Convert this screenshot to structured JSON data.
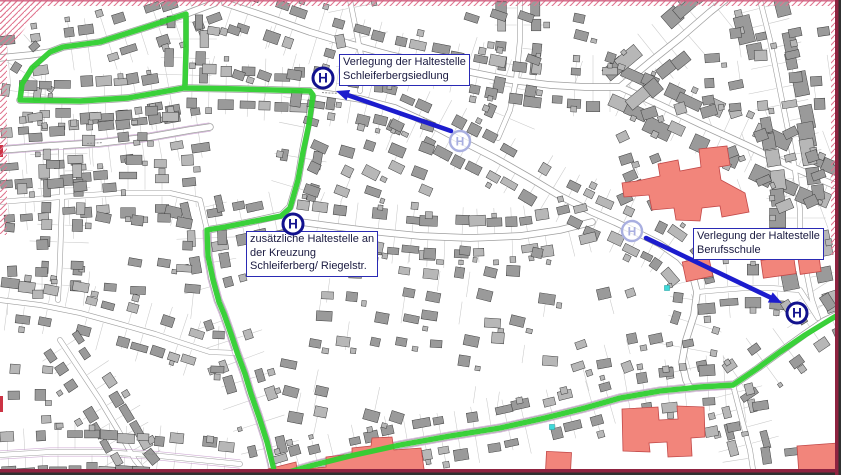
{
  "map": {
    "h_symbol": "H",
    "colors": {
      "route_green": "#2fcf2f",
      "annotation_blue": "#1c1ccd",
      "h_navy": "#12128e",
      "faded_stop": "#a9afe0",
      "building_gray": "#9a9a9a",
      "building_light": "#b7b7b7",
      "building_stroke": "#3f3f3f",
      "road_casing": "#9f9f9f",
      "lot_line": "#c9c9c9",
      "violet_line": "#c9a0cf",
      "landmark_red": "#f2857b",
      "landmark_stroke": "#c24848",
      "hatch_pink": "#e0758f",
      "frame_maroon": "#8e2340",
      "frame_dark": "#303030",
      "cyan_marker": "#3fd9d9",
      "edge_tick_red": "#cc3344"
    },
    "labels": [
      {
        "x": 339,
        "y": 54,
        "lines": [
          "Verlegung der Haltestelle",
          "Schleiferbergsiedlung",
          ""
        ]
      },
      {
        "x": 246,
        "y": 231,
        "lines": [
          "zusätzliche Haltestelle an",
          "der Kreuzung",
          "Schleiferberg/ Riegelstr."
        ]
      },
      {
        "x": 693,
        "y": 228,
        "lines": [
          "Verlegung der Haltestelle",
          "Berufsschule",
          ""
        ]
      }
    ],
    "stops_new": [
      {
        "x": 323,
        "y": 78
      },
      {
        "x": 293,
        "y": 224
      },
      {
        "x": 797,
        "y": 313
      }
    ],
    "stops_old": [
      {
        "x": 460,
        "y": 141
      },
      {
        "x": 632,
        "y": 231
      }
    ],
    "arrows": [
      {
        "from": [
          451,
          131
        ],
        "to": [
          336,
          91
        ]
      },
      {
        "from": [
          646,
          238
        ],
        "to": [
          782,
          303
        ]
      }
    ],
    "route": [
      [
        184,
        88
      ],
      [
        128,
        98
      ],
      [
        80,
        101
      ],
      [
        20,
        100
      ],
      [
        22,
        84
      ],
      [
        32,
        68
      ],
      [
        50,
        52
      ],
      [
        63,
        47
      ],
      [
        100,
        42
      ],
      [
        150,
        26
      ],
      [
        186,
        14
      ],
      [
        186,
        50
      ],
      [
        185,
        85
      ],
      [
        184,
        88
      ],
      [
        240,
        89
      ],
      [
        310,
        91
      ],
      [
        313,
        95
      ],
      [
        309,
        124
      ],
      [
        303,
        152
      ],
      [
        298,
        180
      ],
      [
        290,
        208
      ],
      [
        281,
        216
      ],
      [
        250,
        222
      ],
      [
        225,
        227
      ],
      [
        207,
        230
      ],
      [
        208,
        256
      ],
      [
        213,
        280
      ],
      [
        219,
        302
      ],
      [
        224,
        314
      ],
      [
        231,
        334
      ],
      [
        238,
        355
      ],
      [
        245,
        374
      ],
      [
        251,
        394
      ],
      [
        259,
        417
      ],
      [
        267,
        442
      ],
      [
        273,
        466
      ],
      [
        275,
        476
      ],
      [
        310,
        466
      ],
      [
        350,
        456
      ],
      [
        400,
        445
      ],
      [
        450,
        436
      ],
      [
        500,
        428
      ],
      [
        545,
        418
      ],
      [
        585,
        408
      ],
      [
        620,
        398
      ],
      [
        660,
        391
      ],
      [
        700,
        387
      ],
      [
        733,
        385
      ],
      [
        758,
        368
      ],
      [
        780,
        352
      ],
      [
        805,
        335
      ],
      [
        836,
        316
      ]
    ],
    "roads": [
      {
        "p": [
          [
            0,
            58
          ],
          [
            30,
            55
          ],
          [
            50,
            52
          ],
          [
            63,
            47
          ],
          [
            100,
            42
          ],
          [
            150,
            26
          ],
          [
            186,
            14
          ],
          [
            215,
            3
          ]
        ],
        "w": "m"
      },
      {
        "p": [
          [
            186,
            14
          ],
          [
            186,
            50
          ],
          [
            185,
            85
          ]
        ],
        "w": "s"
      },
      {
        "p": [
          [
            50,
            52
          ],
          [
            32,
            68
          ],
          [
            22,
            84
          ],
          [
            20,
            100
          ]
        ],
        "w": "s"
      },
      {
        "p": [
          [
            20,
            100
          ],
          [
            80,
            101
          ],
          [
            128,
            98
          ],
          [
            184,
            88
          ],
          [
            240,
            89
          ],
          [
            310,
            91
          ],
          [
            360,
            99
          ],
          [
            395,
            108
          ],
          [
            430,
            124
          ],
          [
            460,
            140
          ],
          [
            495,
            158
          ],
          [
            530,
            178
          ],
          [
            560,
            196
          ],
          [
            592,
            212
          ],
          [
            615,
            222
          ],
          [
            632,
            230
          ],
          [
            660,
            244
          ],
          [
            680,
            258
          ],
          [
            692,
            272
          ],
          [
            697,
            292
          ],
          [
            694,
            315
          ],
          [
            686,
            340
          ],
          [
            682,
            362
          ],
          [
            686,
            380
          ],
          [
            690,
            388
          ]
        ],
        "w": "m"
      },
      {
        "p": [
          [
            313,
            93
          ],
          [
            309,
            120
          ],
          [
            303,
            150
          ],
          [
            298,
            180
          ],
          [
            290,
            207
          ],
          [
            282,
            215
          ]
        ],
        "w": "m"
      },
      {
        "p": [
          [
            282,
            215
          ],
          [
            250,
            222
          ],
          [
            225,
            227
          ],
          [
            207,
            230
          ]
        ],
        "w": "m"
      },
      {
        "p": [
          [
            207,
            230
          ],
          [
            208,
            255
          ],
          [
            212,
            278
          ],
          [
            218,
            300
          ],
          [
            223,
            312
          ],
          [
            230,
            332
          ],
          [
            237,
            353
          ],
          [
            244,
            372
          ],
          [
            250,
            392
          ],
          [
            258,
            415
          ],
          [
            266,
            440
          ],
          [
            272,
            465
          ],
          [
            274,
            476
          ]
        ],
        "w": "m",
        "v": true
      },
      {
        "p": [
          [
            276,
            476
          ],
          [
            310,
            466
          ],
          [
            350,
            456
          ],
          [
            400,
            445
          ],
          [
            450,
            436
          ],
          [
            500,
            428
          ],
          [
            545,
            418
          ],
          [
            585,
            408
          ],
          [
            620,
            398
          ],
          [
            660,
            391
          ],
          [
            700,
            387
          ],
          [
            733,
            385
          ]
        ],
        "w": "m",
        "v": true
      },
      {
        "p": [
          [
            733,
            385
          ],
          [
            758,
            368
          ],
          [
            780,
            352
          ],
          [
            805,
            334
          ],
          [
            824,
            321
          ],
          [
            841,
            313
          ]
        ],
        "w": "m"
      },
      {
        "p": [
          [
            282,
            215
          ],
          [
            293,
            221
          ],
          [
            330,
            226
          ],
          [
            370,
            231
          ],
          [
            420,
            236
          ],
          [
            470,
            238
          ],
          [
            520,
            236
          ],
          [
            560,
            230
          ],
          [
            592,
            222
          ]
        ],
        "w": "m"
      },
      {
        "p": [
          [
            620,
            87
          ],
          [
            660,
            105
          ],
          [
            700,
            124
          ],
          [
            748,
            146
          ],
          [
            790,
            166
          ],
          [
            841,
            188
          ]
        ],
        "w": "m",
        "big": true
      },
      {
        "p": [
          [
            620,
            87
          ],
          [
            650,
            62
          ],
          [
            680,
            38
          ],
          [
            710,
            12
          ],
          [
            725,
            0
          ]
        ],
        "w": "m",
        "big": true
      },
      {
        "p": [
          [
            760,
            0
          ],
          [
            770,
            40
          ],
          [
            778,
            80
          ],
          [
            788,
            130
          ],
          [
            795,
            170
          ],
          [
            800,
            210
          ],
          [
            800,
            240
          ],
          [
            806,
            270
          ],
          [
            812,
            300
          ],
          [
            818,
            318
          ]
        ],
        "w": "s",
        "big": true
      },
      {
        "p": [
          [
            350,
            0
          ],
          [
            356,
            30
          ],
          [
            362,
            60
          ],
          [
            360,
            91
          ]
        ],
        "w": "s"
      },
      {
        "p": [
          [
            520,
            0
          ],
          [
            520,
            40
          ],
          [
            516,
            80
          ],
          [
            510,
            110
          ],
          [
            498,
            138
          ]
        ],
        "w": "s"
      },
      {
        "p": [
          [
            0,
            150
          ],
          [
            50,
            146
          ],
          [
            100,
            143
          ],
          [
            150,
            137
          ],
          [
            190,
            130
          ],
          [
            210,
            127
          ]
        ],
        "w": "m",
        "v": true
      },
      {
        "p": [
          [
            0,
            202
          ],
          [
            60,
            197
          ],
          [
            120,
            193
          ],
          [
            170,
            193
          ],
          [
            200,
            200
          ],
          [
            207,
            230
          ]
        ],
        "w": "s"
      },
      {
        "p": [
          [
            0,
            300
          ],
          [
            40,
            305
          ],
          [
            80,
            313
          ],
          [
            120,
            324
          ],
          [
            155,
            334
          ],
          [
            185,
            344
          ],
          [
            210,
            352
          ],
          [
            237,
            353
          ]
        ],
        "w": "s"
      },
      {
        "p": [
          [
            60,
            340
          ],
          [
            80,
            370
          ],
          [
            100,
            400
          ],
          [
            118,
            430
          ],
          [
            135,
            460
          ],
          [
            148,
            476
          ]
        ],
        "w": "s"
      },
      {
        "p": [
          [
            0,
            455
          ],
          [
            50,
            452
          ],
          [
            100,
            452
          ],
          [
            150,
            455
          ],
          [
            200,
            460
          ],
          [
            240,
            464
          ]
        ],
        "w": "s",
        "v": true
      },
      {
        "p": [
          [
            61,
            146
          ],
          [
            62,
            200
          ],
          [
            60,
            260
          ],
          [
            58,
            300
          ]
        ],
        "w": "s"
      },
      {
        "p": [
          [
            697,
            292
          ],
          [
            720,
            290
          ],
          [
            745,
            288
          ],
          [
            770,
            288
          ],
          [
            800,
            290
          ],
          [
            818,
            318
          ]
        ],
        "w": "s"
      },
      {
        "p": [
          [
            225,
            3
          ],
          [
            270,
            18
          ],
          [
            310,
            32
          ],
          [
            350,
            44
          ],
          [
            390,
            55
          ],
          [
            430,
            64
          ],
          [
            470,
            72
          ],
          [
            510,
            80
          ],
          [
            550,
            85
          ],
          [
            585,
            87
          ],
          [
            620,
            87
          ]
        ],
        "w": "m"
      },
      {
        "p": [
          [
            733,
            385
          ],
          [
            742,
            420
          ],
          [
            750,
            450
          ],
          [
            754,
            476
          ]
        ],
        "w": "s"
      }
    ],
    "zones": [
      {
        "x": 28,
        "y": 104,
        "w": 150,
        "h": 42,
        "r": -5,
        "d": 0.7
      },
      {
        "x": 15,
        "y": 152,
        "w": 190,
        "h": 46,
        "r": -4,
        "d": 0.7
      },
      {
        "x": 70,
        "y": 210,
        "w": 130,
        "h": 88,
        "r": 6,
        "d": 0.5
      },
      {
        "x": 305,
        "y": 115,
        "w": 140,
        "h": 90,
        "r": 22,
        "d": 0.7
      },
      {
        "x": 315,
        "y": 240,
        "w": 245,
        "h": 92,
        "r": 8,
        "d": 0.65
      },
      {
        "x": 565,
        "y": 285,
        "w": 120,
        "h": 95,
        "r": -15,
        "d": 0.55
      },
      {
        "x": 615,
        "y": 100,
        "w": 222,
        "h": 115,
        "r": -20,
        "d": 0.5
      },
      {
        "x": 282,
        "y": 335,
        "w": 140,
        "h": 85,
        "r": 12,
        "d": 0.6
      },
      {
        "x": 430,
        "y": 330,
        "w": 130,
        "h": 72,
        "r": 8,
        "d": 0.55
      },
      {
        "x": 700,
        "y": 25,
        "w": 138,
        "h": 95,
        "r": -8,
        "d": 0.7
      },
      {
        "x": 465,
        "y": 5,
        "w": 150,
        "h": 75,
        "r": 18,
        "d": 0.55
      },
      {
        "x": 5,
        "y": 340,
        "w": 55,
        "h": 85,
        "r": 2,
        "d": 0.55
      },
      {
        "x": 700,
        "y": 395,
        "w": 105,
        "h": 72,
        "r": -8,
        "d": 0.4
      },
      {
        "x": 200,
        "y": 20,
        "w": 108,
        "h": 58,
        "r": 15,
        "d": 0.55
      },
      {
        "x": 0,
        "y": 215,
        "w": 68,
        "h": 80,
        "r": 0,
        "d": 0.45
      }
    ],
    "landmarks": {
      "paths": [
        "M637,181 L660,176 L658,164 L678,160 L680,171 L701,167 L699,149 L727,146 L730,165 L719,167 L721,180 L745,193 L749,212 L722,217 L720,206 L702,208 L700,221 L676,220 L674,208 L652,210 L649,195 L624,197 L622,183 Z",
        "M268,469 L296,462 L297,470 L326,467 L326,457 L352,454 L352,448 L371,446 L372,438 L392,437 L394,450 L421,448 L425,476 L268,476 Z",
        "M622,409 L658,407 L659,420 L678,419 L677,406 L704,407 L705,437 L691,438 L692,456 L668,457 L667,442 L649,443 L650,452 L623,451 Z",
        "M797,446 L838,443 L841,444 L841,475 L799,475 Z"
      ],
      "rects": [
        {
          "x": 684,
          "y": 259,
          "w": 27,
          "h": 20,
          "r": -12
        },
        {
          "x": 762,
          "y": 258,
          "w": 33,
          "h": 18,
          "r": -8
        },
        {
          "x": 799,
          "y": 256,
          "w": 21,
          "h": 17,
          "r": -8
        },
        {
          "x": 546,
          "y": 452,
          "w": 25,
          "h": 20,
          "r": 3
        }
      ]
    },
    "hatch": {
      "rects": [
        [
          0,
          0,
          841,
          6
        ],
        [
          0,
          0,
          7,
          235
        ],
        [
          831,
          0,
          10,
          255
        ]
      ],
      "poly": "M0,0 L48,0 L14,42 L0,48 Z"
    },
    "cyan_markers": [
      [
        552,
        427
      ],
      [
        667,
        288
      ]
    ],
    "edge_ticks": [
      [
        0,
        396,
        3,
        16
      ],
      [
        0,
        145,
        3,
        12
      ]
    ],
    "street_marks": [
      {
        "x": 430,
        "y": 121,
        "a": 28
      },
      {
        "x": 222,
        "y": 310,
        "a": 80
      },
      {
        "x": 470,
        "y": 431,
        "a": -10
      },
      {
        "x": 95,
        "y": 143,
        "a": -3
      },
      {
        "x": 150,
        "y": 454,
        "a": 2
      },
      {
        "x": 330,
        "y": 93,
        "a": 3
      }
    ]
  }
}
